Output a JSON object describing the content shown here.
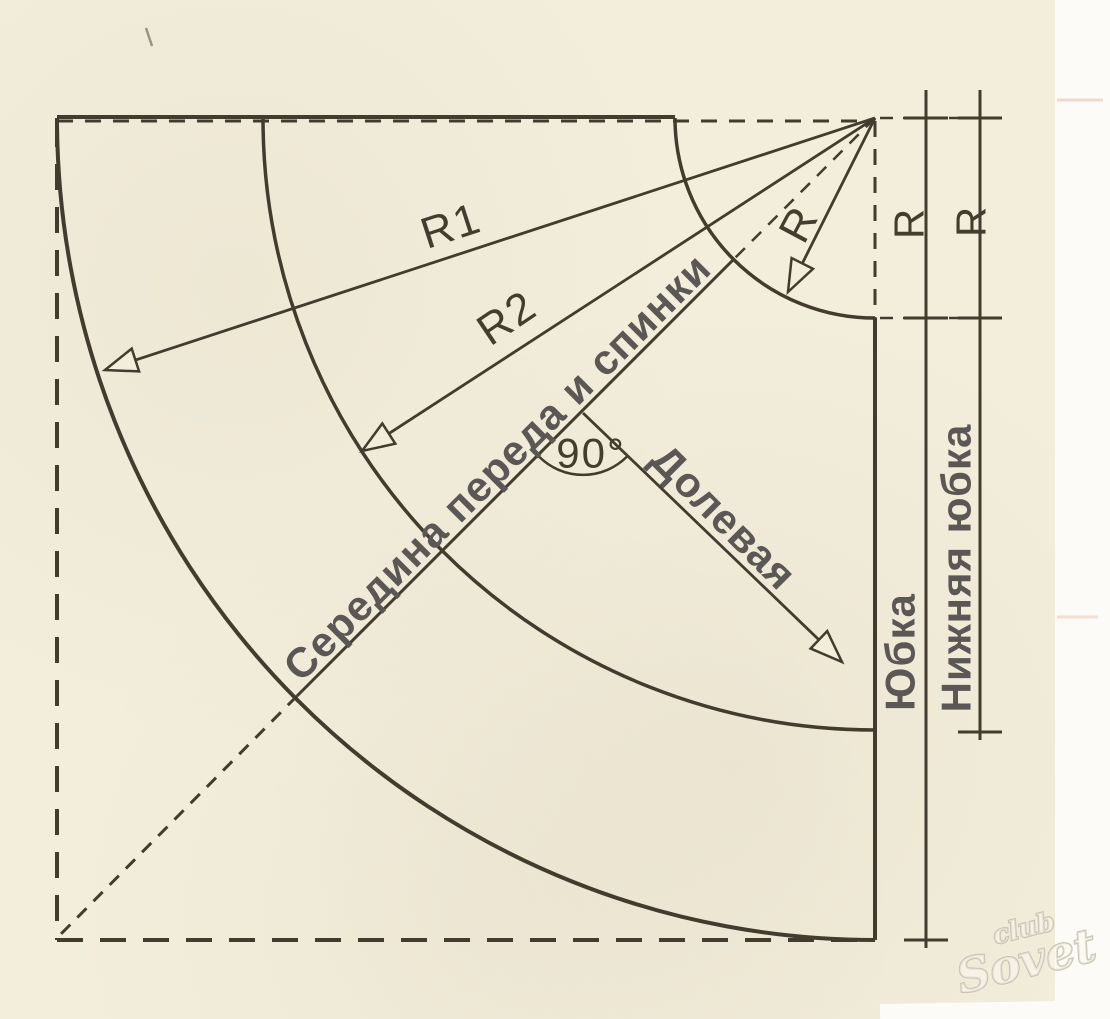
{
  "diagram": {
    "title": "Skirt and underskirt quarter-circle pattern drafting scheme",
    "labels": {
      "r1": "R1",
      "r2": "R2",
      "r": "R",
      "angle": "90°",
      "center_front_back": "Середина переда и спинки",
      "grain": "Долевая"
    },
    "dimensions": {
      "skirt_radius": "R",
      "underskirt_radius": "R",
      "skirt": "Юбка",
      "underskirt": "Нижняя юбка"
    },
    "watermark": {
      "top": "club",
      "bottom": "Sovet"
    },
    "colors": {
      "paper": "#f3eedc",
      "page_margin": "#fcfbf7",
      "ink": "#423b2e",
      "tech": "#443c2f",
      "label_gray": "#5a5755",
      "watermark": "#c8c3b4"
    }
  }
}
